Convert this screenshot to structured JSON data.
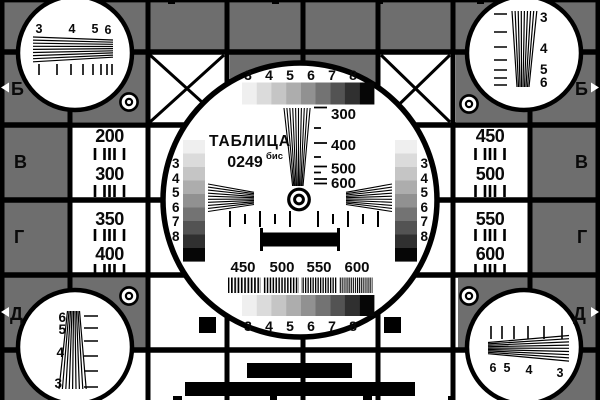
{
  "card": {
    "title": "ТАБЛИЦА",
    "number": "0249",
    "number_suffix": "бис"
  },
  "colors": {
    "background": "#6e6e6e",
    "surface": "#ffffff",
    "line": "#000000"
  },
  "grayscale_steps": [
    "#efefef",
    "#dbdbdb",
    "#c5c5c5",
    "#adadad",
    "#919191",
    "#737373",
    "#535353",
    "#303030",
    "#060606"
  ],
  "row_labels_left": [
    "Б",
    "В",
    "Г",
    "Д"
  ],
  "row_labels_right": [
    "Б",
    "В",
    "Г",
    "Д"
  ],
  "top_scale_digits": [
    "3",
    "4",
    "5",
    "6",
    "7",
    "8"
  ],
  "bottom_scale_digits": [
    "3",
    "4",
    "5",
    "6",
    "7",
    "8"
  ],
  "left_column_digits": [
    "3",
    "4",
    "5",
    "6",
    "7",
    "8"
  ],
  "right_column_digits": [
    "3",
    "4",
    "5",
    "6",
    "7",
    "8"
  ],
  "center_wedge_labels": [
    "300",
    "400",
    "500",
    "600"
  ],
  "burst_labels": [
    "450",
    "500",
    "550",
    "600"
  ],
  "left_cells": [
    "200",
    "300",
    "350",
    "400"
  ],
  "right_cells": [
    "450",
    "500",
    "550",
    "600"
  ],
  "corner_circles": {
    "top_left_digits": [
      "3",
      "4",
      "5",
      "6"
    ],
    "top_right_digits": [
      "3",
      "4",
      "5",
      "6"
    ],
    "bottom_left_digits": [
      "6",
      "5",
      "4",
      "3"
    ],
    "bottom_right_digits": [
      "6",
      "5",
      "4",
      "3"
    ]
  }
}
